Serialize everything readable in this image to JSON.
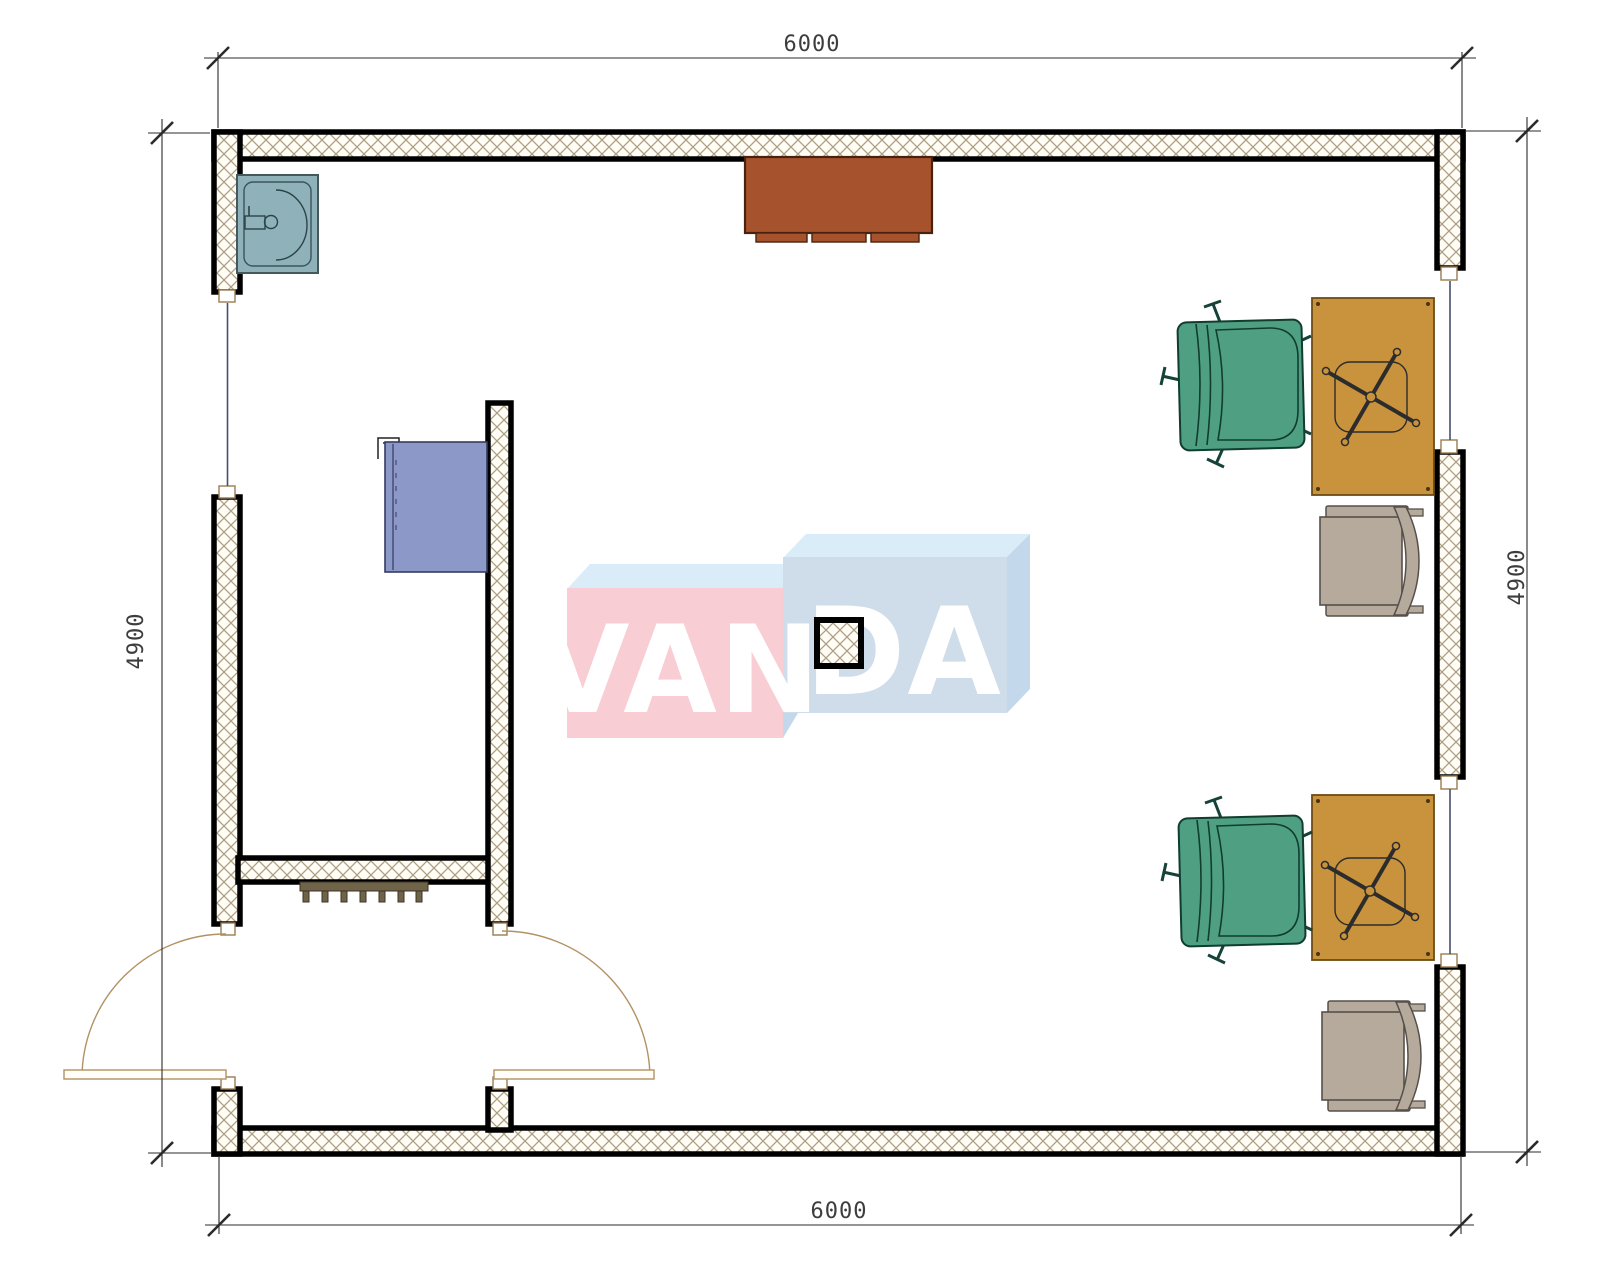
{
  "drawing": {
    "kind": "architectural floor plan, top view, CAD style",
    "room_label_width_mm": "6000",
    "room_label_depth_mm": "4900"
  },
  "dimensions": {
    "top": "6000",
    "bottom": "6000",
    "left": "4900",
    "right": "4900"
  },
  "watermark": {
    "text_left": "VAN",
    "text_right": "DA",
    "pink_face": "#f8cdd4",
    "blue_face": "#cfdcea",
    "top_band_blue": "#d9ecf8",
    "side_band_blue": "#c3d8ea"
  },
  "colors": {
    "wall_edge": "#000000",
    "wall_hatch_line": "#ac9f83",
    "cabinet_brown": "#a6522c",
    "desk_tan": "#c8933c",
    "office_chair_green": "#4fa083",
    "guest_chair_taupe": "#b5aa9c",
    "sink_teal": "#8fb2ba",
    "sideboard_blue": "#8c98c7",
    "radiator_olive": "#6f6349",
    "door_swing_tan": "#b29263",
    "glazing_blue": "#44506e",
    "dimension_gray": "#3d3d3d"
  },
  "furniture": [
    {
      "name": "sink",
      "location": "top-left corner"
    },
    {
      "name": "storage-cabinet",
      "location": "top wall, center"
    },
    {
      "name": "blue-sideboard",
      "location": "on interior partition"
    },
    {
      "name": "desk-upper",
      "location": "right wall"
    },
    {
      "name": "desk-lower",
      "location": "right wall"
    },
    {
      "name": "office-chair-upper",
      "location": "left of upper desk"
    },
    {
      "name": "office-chair-lower",
      "location": "left of lower desk"
    },
    {
      "name": "guest-chair-upper",
      "location": "below upper desk"
    },
    {
      "name": "guest-chair-lower",
      "location": "below lower desk"
    },
    {
      "name": "radiator",
      "location": "vestibule partition"
    },
    {
      "name": "column",
      "location": "room center"
    },
    {
      "name": "double-swing-doors",
      "location": "bottom-left vestibule"
    }
  ]
}
